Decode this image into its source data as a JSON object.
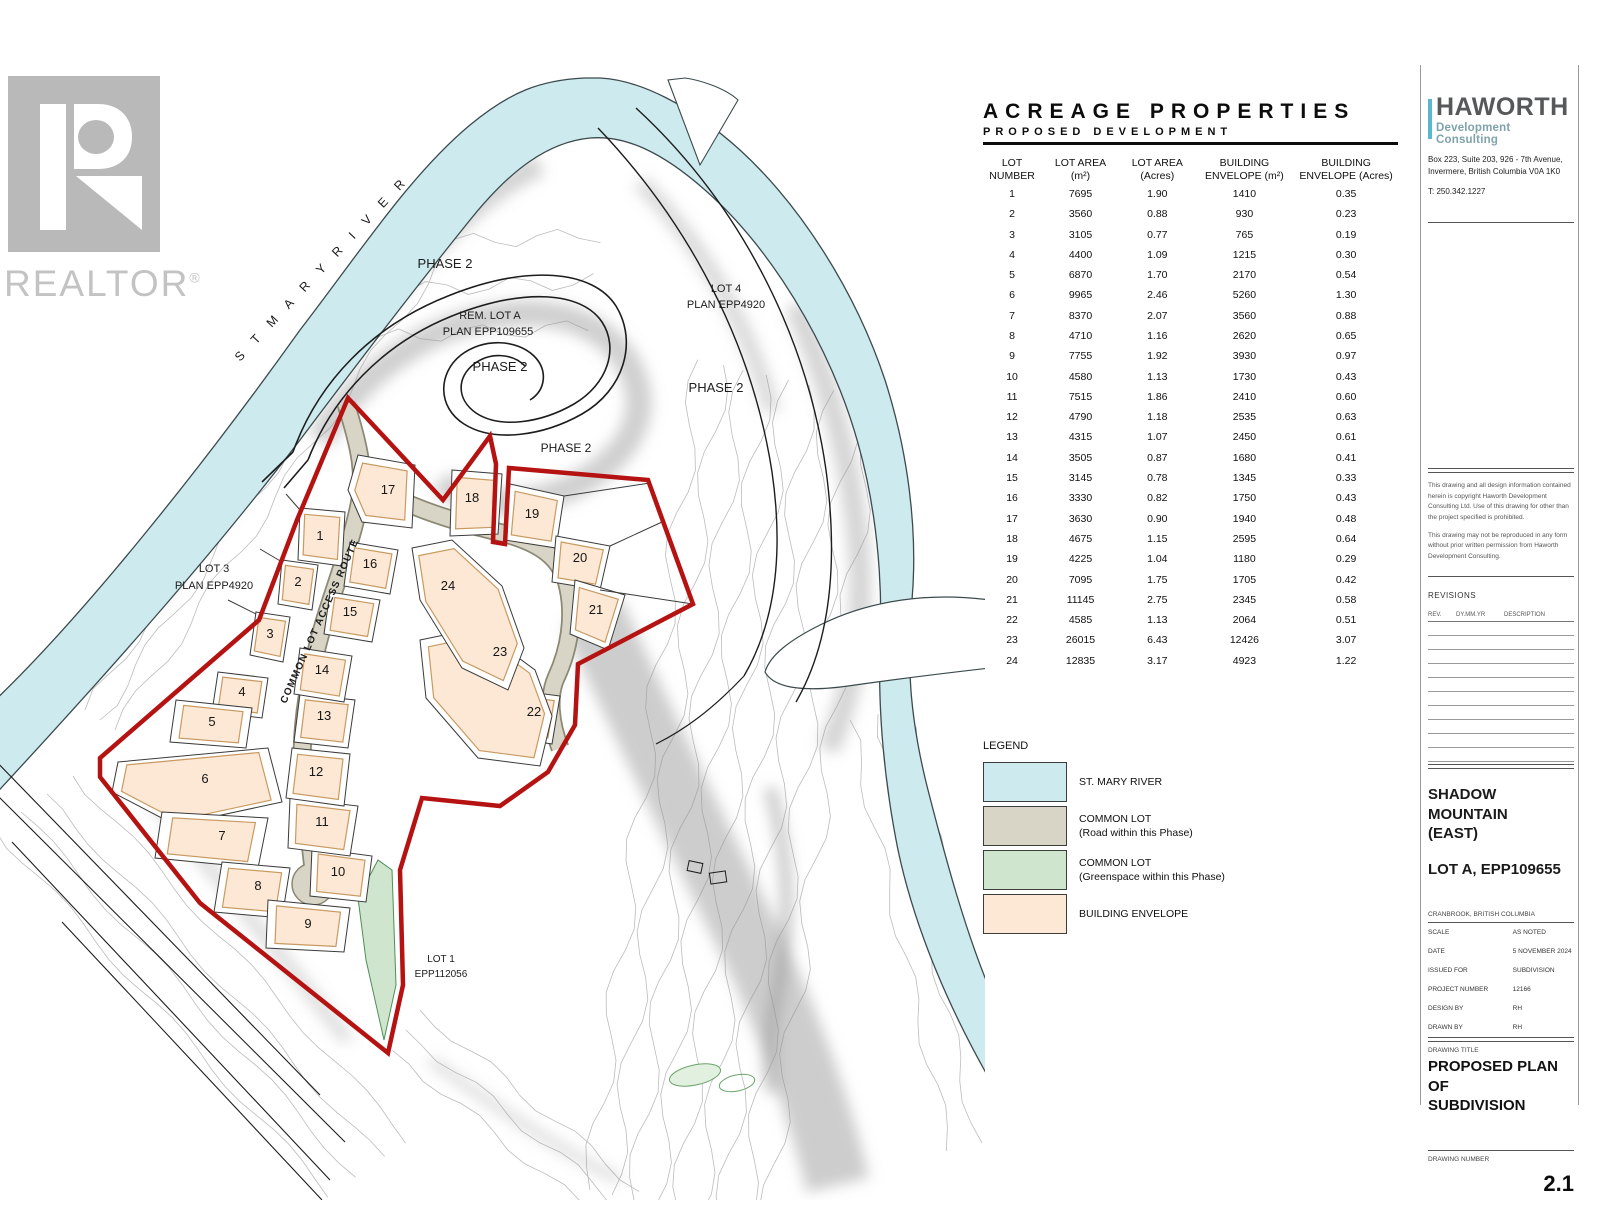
{
  "watermark": {
    "realtor": "REALTOR",
    "registered": "®"
  },
  "table": {
    "title": "ACREAGE PROPERTIES",
    "subtitle": "PROPOSED DEVELOPMENT",
    "columns": [
      {
        "l1": "LOT",
        "l2": "NUMBER"
      },
      {
        "l1": "LOT AREA",
        "l2": "(m²)"
      },
      {
        "l1": "LOT AREA",
        "l2": "(Acres)"
      },
      {
        "l1": "BUILDING",
        "l2": "ENVELOPE (m²)"
      },
      {
        "l1": "BUILDING",
        "l2": "ENVELOPE (Acres)"
      }
    ],
    "rows": [
      [
        "1",
        "7695",
        "1.90",
        "1410",
        "0.35"
      ],
      [
        "2",
        "3560",
        "0.88",
        "930",
        "0.23"
      ],
      [
        "3",
        "3105",
        "0.77",
        "765",
        "0.19"
      ],
      [
        "4",
        "4400",
        "1.09",
        "1215",
        "0.30"
      ],
      [
        "5",
        "6870",
        "1.70",
        "2170",
        "0.54"
      ],
      [
        "6",
        "9965",
        "2.46",
        "5260",
        "1.30"
      ],
      [
        "7",
        "8370",
        "2.07",
        "3560",
        "0.88"
      ],
      [
        "8",
        "4710",
        "1.16",
        "2620",
        "0.65"
      ],
      [
        "9",
        "7755",
        "1.92",
        "3930",
        "0.97"
      ],
      [
        "10",
        "4580",
        "1.13",
        "1730",
        "0.43"
      ],
      [
        "11",
        "7515",
        "1.86",
        "2410",
        "0.60"
      ],
      [
        "12",
        "4790",
        "1.18",
        "2535",
        "0.63"
      ],
      [
        "13",
        "4315",
        "1.07",
        "2450",
        "0.61"
      ],
      [
        "14",
        "3505",
        "0.87",
        "1680",
        "0.41"
      ],
      [
        "15",
        "3145",
        "0.78",
        "1345",
        "0.33"
      ],
      [
        "16",
        "3330",
        "0.82",
        "1750",
        "0.43"
      ],
      [
        "17",
        "3630",
        "0.90",
        "1940",
        "0.48"
      ],
      [
        "18",
        "4675",
        "1.15",
        "2595",
        "0.64"
      ],
      [
        "19",
        "4225",
        "1.04",
        "1180",
        "0.29"
      ],
      [
        "20",
        "7095",
        "1.75",
        "1705",
        "0.42"
      ],
      [
        "21",
        "11145",
        "2.75",
        "2345",
        "0.58"
      ],
      [
        "22",
        "4585",
        "1.13",
        "2064",
        "0.51"
      ],
      [
        "23",
        "26015",
        "6.43",
        "12426",
        "3.07"
      ],
      [
        "24",
        "12835",
        "3.17",
        "4923",
        "1.22"
      ]
    ]
  },
  "legend": {
    "title": "LEGEND",
    "items": [
      {
        "lines": [
          "ST. MARY RIVER"
        ],
        "color": "#cdeaee"
      },
      {
        "lines": [
          "COMMON LOT",
          "(Road within this Phase)"
        ],
        "color": "#d8d5c7"
      },
      {
        "lines": [
          "COMMON LOT",
          "(Greenspace within this Phase)"
        ],
        "color": "#cfe5cd"
      },
      {
        "lines": [
          "BUILDING ENVELOPE"
        ],
        "color": "#fce8d4"
      }
    ]
  },
  "map": {
    "lot_numbers": [
      "1",
      "2",
      "3",
      "4",
      "5",
      "6",
      "7",
      "8",
      "9",
      "10",
      "11",
      "12",
      "13",
      "14",
      "15",
      "16",
      "17",
      "18",
      "19",
      "20",
      "21",
      "22",
      "23",
      "24"
    ],
    "labels": {
      "phase_2": "PHASE 2",
      "rem_lot_a_1": "REM. LOT A",
      "rem_lot_a_2": "PLAN EPP109655",
      "lot4_1": "LOT 4",
      "lot4_2": "PLAN EPP4920",
      "lot3_1": "LOT 3",
      "lot3_2": "PLAN EPP4920",
      "lot1_1": "LOT 1",
      "lot1_2": "EPP112056",
      "river": "S T   M A R Y   R I V E R",
      "access_route": "COMMON LOT ACCESS ROUTE"
    }
  },
  "title_block": {
    "firm": "HAWORTH",
    "firm_sub": "Development Consulting",
    "address1": "Box 223, Suite 203, 926 - 7th Avenue,",
    "address2": "Invermere, British Columbia  V0A 1K0",
    "phone": "T:   250.342.1227",
    "copyright1": "This drawing and all design information contained herein is copyright Haworth Development Consulting Ltd. Use of this drawing for other than the project specified is prohibited.",
    "copyright2": "This drawing may not be reproduced in any form without prior written permission from Haworth Development Consulting.",
    "revisions_title": "REVISIONS",
    "revisions_cols": [
      "REV.",
      "DY.MM.YR",
      "DESCRIPTION"
    ],
    "project_name1": "SHADOW MOUNTAIN",
    "project_name2": "(EAST)",
    "project_name3": "LOT A, EPP109655",
    "location": "CRANBROOK, BRITISH COLUMBIA",
    "fields": [
      {
        "label": "SCALE",
        "value": "AS NOTED"
      },
      {
        "label": "DATE",
        "value": "5 NOVEMBER 2024"
      },
      {
        "label": "ISSUED FOR",
        "value": "SUBDIVISION"
      },
      {
        "label": "PROJECT NUMBER",
        "value": "12166"
      },
      {
        "label": "DESIGN BY",
        "value": "RH"
      },
      {
        "label": "DRAWN BY",
        "value": "RH"
      }
    ],
    "drawing_title_label": "DRAWING TITLE",
    "drawing_title1": "PROPOSED PLAN OF",
    "drawing_title2": "SUBDIVISION",
    "drawing_number_label": "DRAWING NUMBER",
    "drawing_number": "2.1"
  },
  "colors": {
    "boundary_red": "#b51212",
    "haworth_teal": "#5ab7cd",
    "river": "#cdeaee",
    "common_lot_road": "#d8d5c7",
    "common_lot_green": "#cfe5cd",
    "building_envelope": "#fce8d4"
  }
}
